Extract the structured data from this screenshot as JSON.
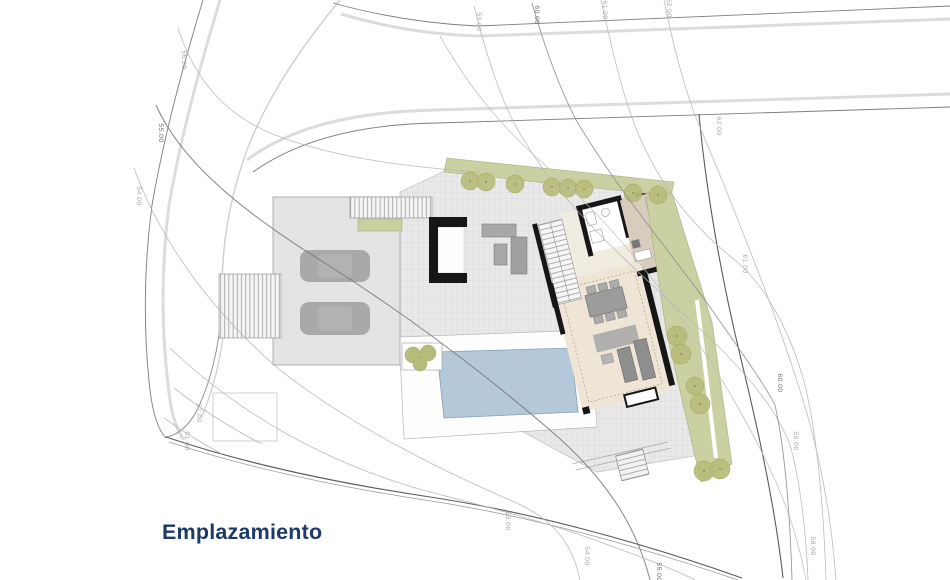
{
  "title": {
    "label": "Emplazamiento"
  },
  "drawing": {
    "kind": "architectural site plan",
    "colors": {
      "title_navy": "#1b3a69",
      "pool_blue": "#b5c8da",
      "garden_olive": "#cbd0a2",
      "tree_olive": "#b7bc7b",
      "terrace_gray": "#e9e9e9",
      "wall_black": "#161616",
      "contour_gray": "#b5b5b5"
    }
  },
  "contour_labels": [
    {
      "value": "56.00"
    },
    {
      "value": "55.00"
    },
    {
      "value": "54.00"
    },
    {
      "value": "59.00"
    },
    {
      "value": "60.00"
    },
    {
      "value": "61.00"
    },
    {
      "value": "62.00"
    },
    {
      "value": "62.00"
    },
    {
      "value": "61.00"
    },
    {
      "value": "60.00"
    },
    {
      "value": "59.00"
    },
    {
      "value": "58.00"
    },
    {
      "value": "52.00"
    },
    {
      "value": "51.00"
    },
    {
      "value": "53.00"
    },
    {
      "value": "54.00"
    },
    {
      "value": "55.00"
    }
  ]
}
